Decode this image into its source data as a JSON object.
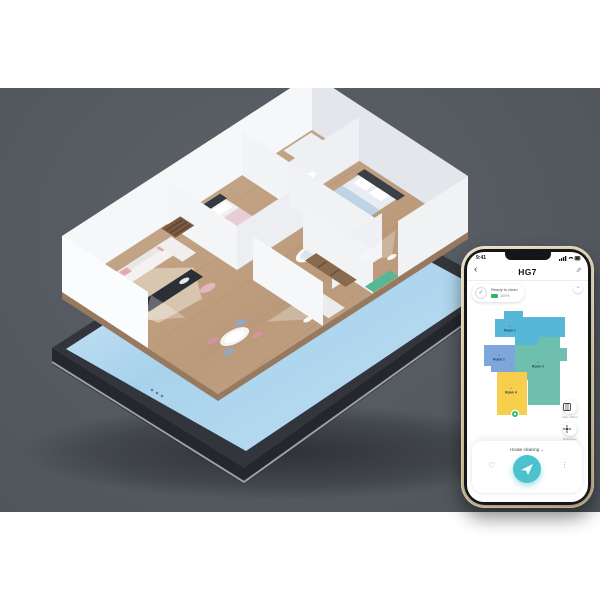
{
  "scene": {
    "backdrop_color": "#555b61",
    "tabletop_phone": {
      "screen_color": "#bfe0f2",
      "buttons": [
        {
          "icon": "app-grid-icon",
          "color": "#5b8fd6"
        },
        {
          "icon": "app-grid-icon",
          "color": "#5b8fd6"
        }
      ]
    },
    "apartment": {
      "floor_color": "#c2a284",
      "wall_color": "#f4f6f8",
      "robot_count": "3"
    }
  },
  "phone_app": {
    "status_bar": {
      "time": "9:41"
    },
    "header": {
      "back_icon": "‹",
      "title": "HG7",
      "edit_icon": "✎"
    },
    "collapse_icon": "⌄",
    "status_pill": {
      "check_icon": "✓",
      "state": "Ready to clean",
      "battery": "100%"
    },
    "map": {
      "rooms": [
        {
          "name": "Room 1",
          "glyph": "⌂",
          "color": "#56b7d9"
        },
        {
          "name": "Room 2",
          "glyph": "⌂",
          "color": "#7da7dc"
        },
        {
          "name": "Room 3",
          "glyph": "⌂",
          "color": "#6fbfae"
        },
        {
          "name": "Room 4",
          "glyph": "⌂",
          "color": "#f8ce4d"
        }
      ],
      "robot_color": "#2fb974"
    },
    "side_buttons": [
      {
        "label": "Map editing",
        "icon": "map-icon"
      },
      {
        "label": "Relocation",
        "icon": "locate-icon"
      }
    ],
    "bottom_sheet": {
      "mode": "House cleaning ⌄",
      "favorite_icon": "♡",
      "start_icon": "paper-plane",
      "more_icon": "⋮",
      "accent_color": "#4cc2cf"
    }
  }
}
